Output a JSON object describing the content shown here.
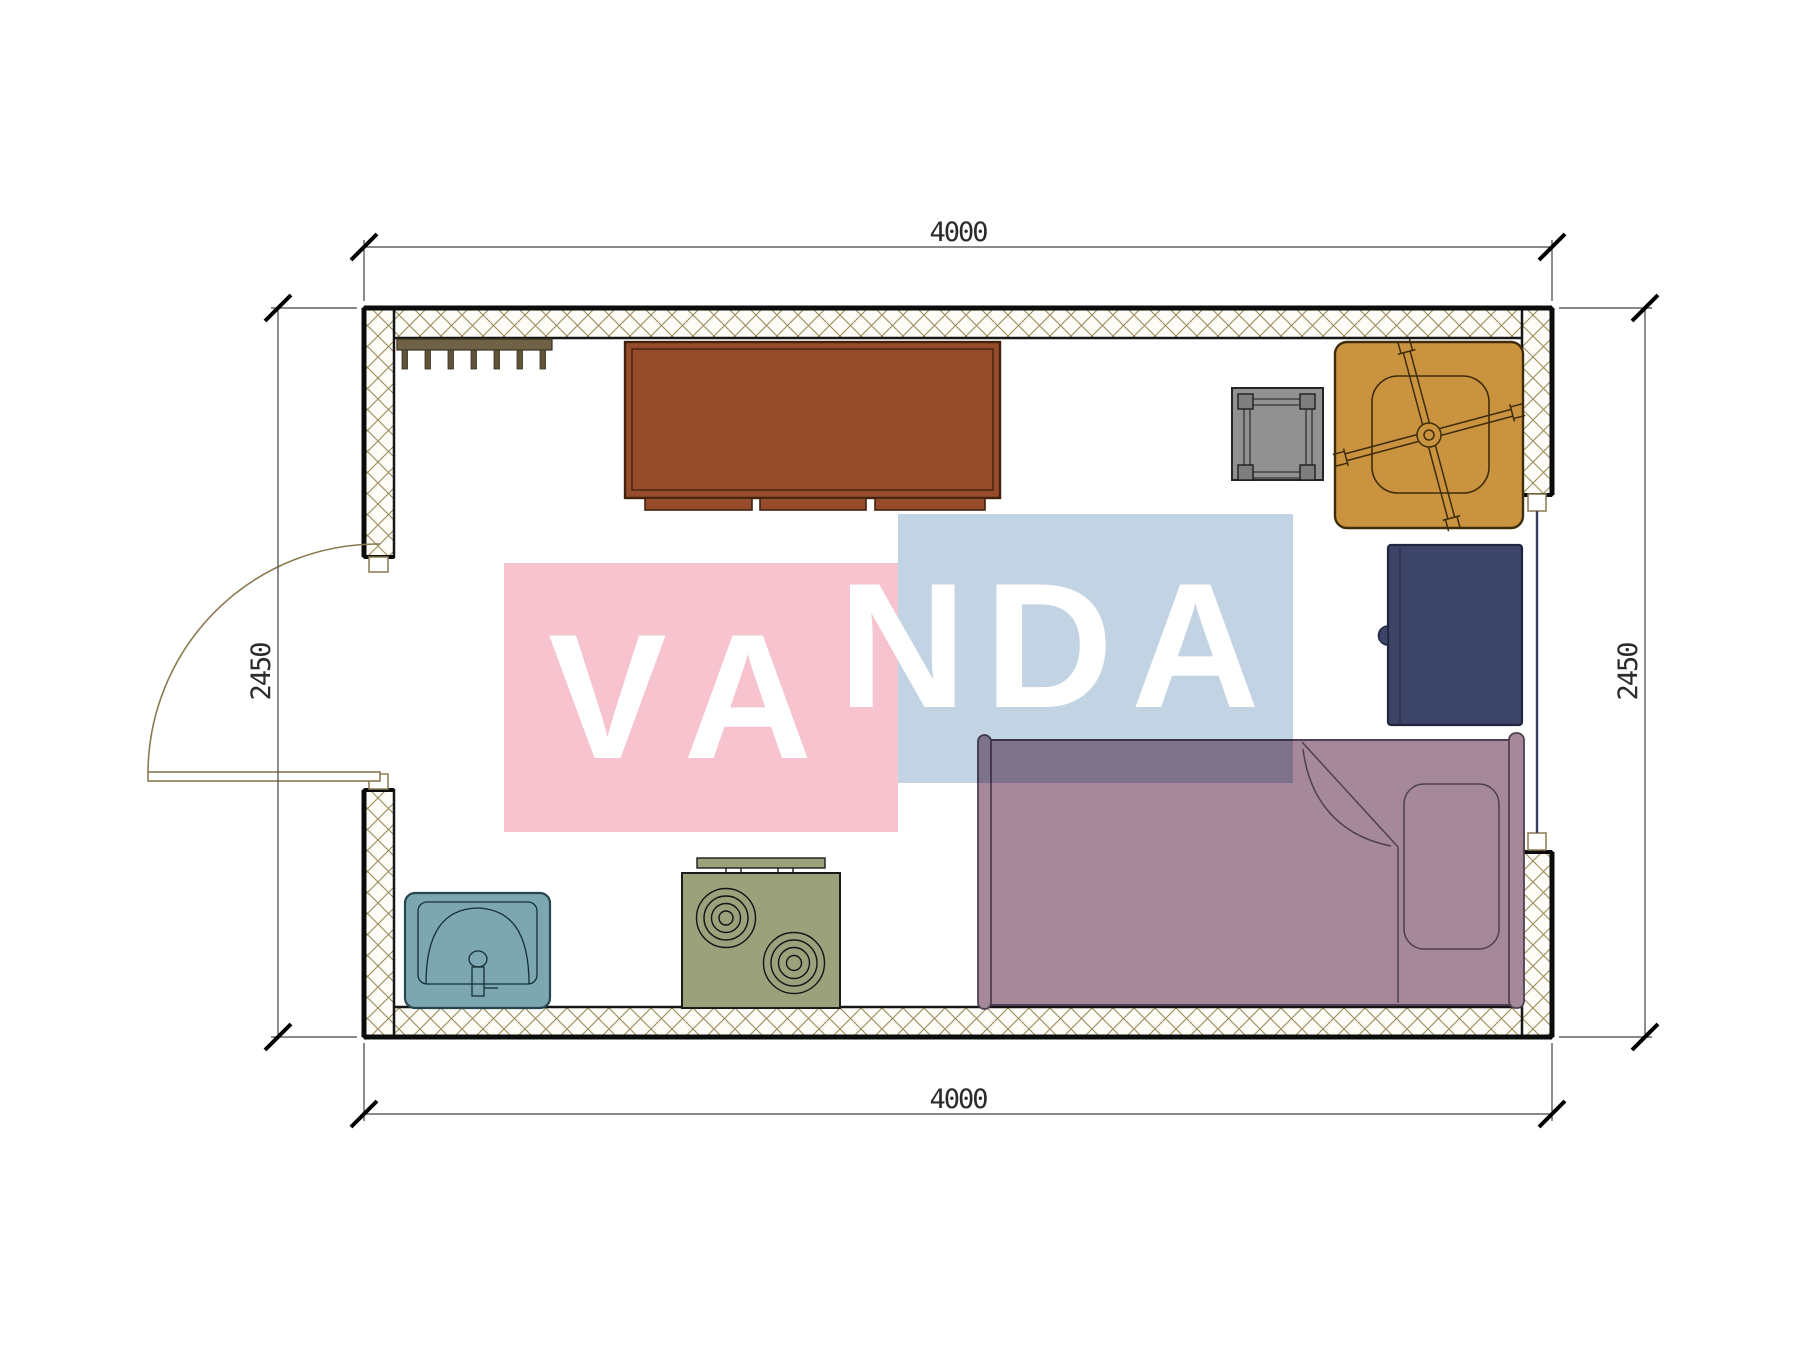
{
  "page": {
    "background": "#ffffff",
    "type": "architectural-floor-plan"
  },
  "dimensions": {
    "top": "4000",
    "bottom": "4000",
    "left": "2450",
    "right": "2450"
  },
  "watermark": {
    "text": "VANDA",
    "segment_left": "VA",
    "segment_right": "NDA",
    "pink_color": "#f6c3cf",
    "blue_color": "#c2d3e4",
    "letter_color": "#ffffff"
  },
  "room": {
    "width_mm": 4000,
    "depth_mm": 2450
  },
  "symbols": [
    {
      "icon": "wall-hatch-pattern",
      "color": "#9b8a5c"
    },
    {
      "icon": "coat-rack-icon",
      "color": "#6f6146"
    },
    {
      "icon": "cabinet-desk-icon",
      "color": "#964c2b"
    },
    {
      "icon": "stool-icon",
      "color": "#919191"
    },
    {
      "icon": "office-chair-icon",
      "color": "#ca9340"
    },
    {
      "icon": "wardrobe-icon",
      "color": "#3c4467"
    },
    {
      "icon": "bed-icon",
      "color": "#a5899a"
    },
    {
      "icon": "sink-icon",
      "color": "#7ca6b0"
    },
    {
      "icon": "stove-icon",
      "color": "#9aa17b"
    },
    {
      "icon": "door-swing-icon",
      "color": "#8a7a50"
    },
    {
      "icon": "window-icon",
      "color": "#3b3c63"
    }
  ]
}
